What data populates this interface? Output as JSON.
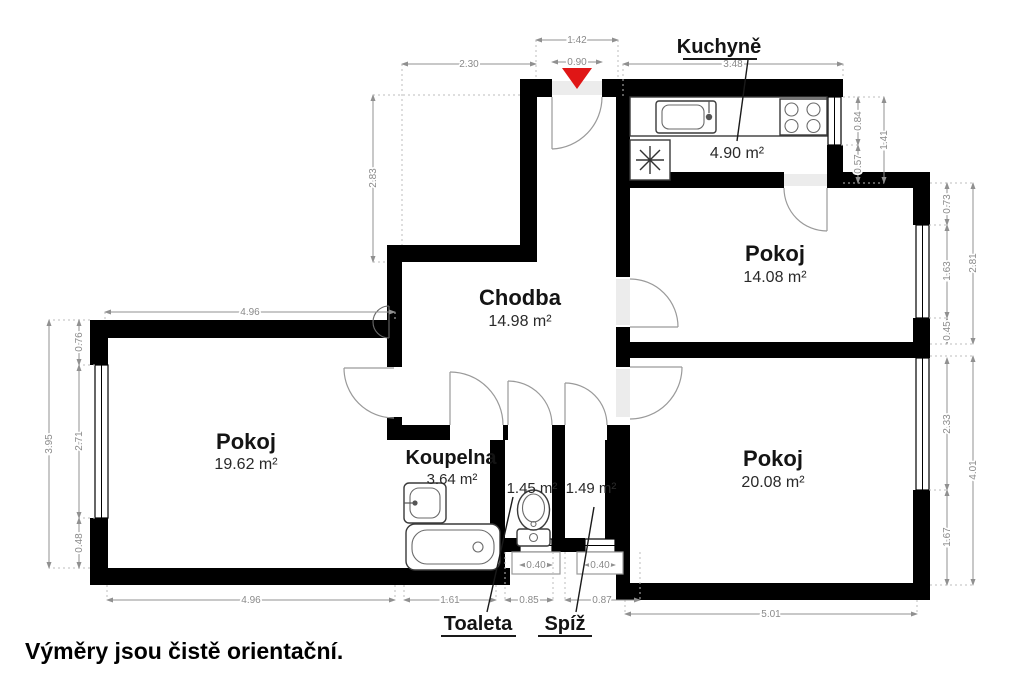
{
  "footer": "Výměry jsou čistě orientační.",
  "rooms": {
    "kuchyne": {
      "name": "Kuchyně",
      "area": "4.90 m²"
    },
    "pokoj_top": {
      "name": "Pokoj",
      "area": "14.08 m²"
    },
    "chodba": {
      "name": "Chodba",
      "area": "14.98 m²"
    },
    "pokoj_left": {
      "name": "Pokoj",
      "area": "19.62 m²"
    },
    "koupelna": {
      "name": "Koupelna",
      "area": "3.64 m²"
    },
    "toaleta": {
      "name": "Toaleta",
      "area": "1.45 m²"
    },
    "spiz": {
      "name": "Spíž",
      "area": "1.49 m²"
    },
    "pokoj_bottom": {
      "name": "Pokoj",
      "area": "20.08 m²"
    }
  },
  "dims": {
    "top_entry_total": "1.42",
    "entry_door_width": "0.90",
    "top_left": "2.30",
    "kitchen_width": "3.48",
    "upper_left_height": "2.83",
    "kitchen_window": "0.84",
    "kitchen_pier": "0.57",
    "kitchen_right_total": "1.41",
    "p14_pier_top": "0.73",
    "p14_window": "1.63",
    "p14_pier_bottom": "0.45",
    "p14_total": "2.81",
    "p20_window": "2.33",
    "p20_pier": "1.67",
    "p20_total": "4.01",
    "left_pier_top": "0.76",
    "left_window": "2.71",
    "left_pier_bottom": "0.48",
    "left_total": "3.95",
    "pokoj_left_width_top": "4.96",
    "pokoj_left_width_bottom": "4.96",
    "koupelna_width": "1.61",
    "toaleta_width": "0.85",
    "toaleta_window": "0.40",
    "spiz_window": "0.40",
    "spiz_width": "0.87",
    "pokoj_bottom_width": "5.01"
  },
  "colors": {
    "wall": "#000000",
    "entrance_marker": "#e01616",
    "sill": "#ececec"
  }
}
